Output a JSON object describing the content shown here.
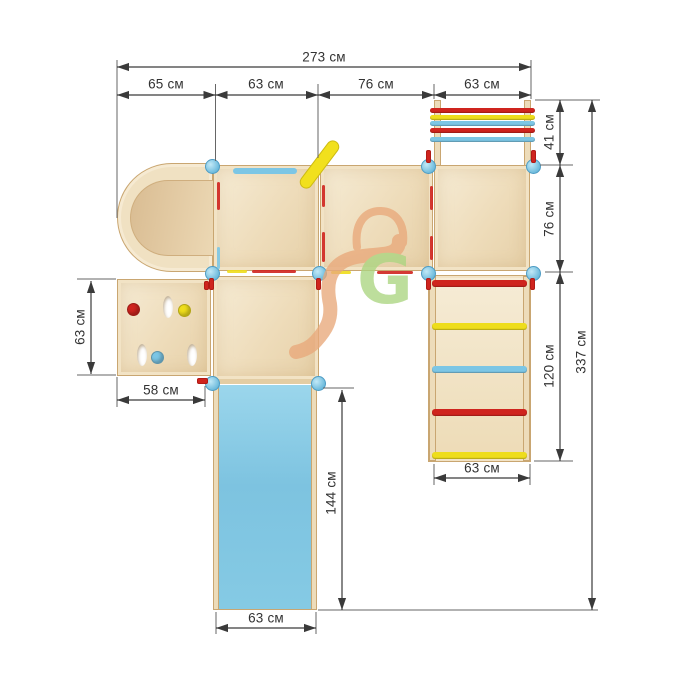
{
  "labels": {
    "total_width": "273 см",
    "tunnel_width": "65 см",
    "platform1_width": "63 см",
    "platform2_width": "76 см",
    "ladder_top_width": "63 см",
    "ladder_top_depth": "41 см",
    "platform_depth": "76 см",
    "ladder_right_length": "120 см",
    "total_height": "337 см",
    "wall_height": "63 см",
    "wall_width": "58 см",
    "slide_length": "144 см",
    "slide_width": "63 см",
    "ladder_right_width": "63 см"
  },
  "watermark": {
    "letter": "G"
  },
  "structure": {
    "top_ladder_rungs": [
      "red",
      "yellow",
      "blue",
      "red",
      "blue"
    ],
    "right_ladder_rungs": [
      "red",
      "yellow",
      "blue",
      "red",
      "yellow"
    ],
    "wall_holds": [
      "red",
      "yellow",
      "blue"
    ]
  },
  "colors": {
    "red": "#cf241e",
    "yellow": "#eedd1b",
    "blue": "#7cc6e5",
    "slide_blue": "#82c7e3",
    "connector_blue": "#79c3e2",
    "wood_light": "#f4e8d0",
    "wood_edge": "#d8bd92",
    "outline": "#c9a671",
    "dimension_line": "#3a3a3a",
    "watermark_orange": "#e9a97b",
    "watermark_green": "#abd581",
    "background": "#ffffff"
  }
}
